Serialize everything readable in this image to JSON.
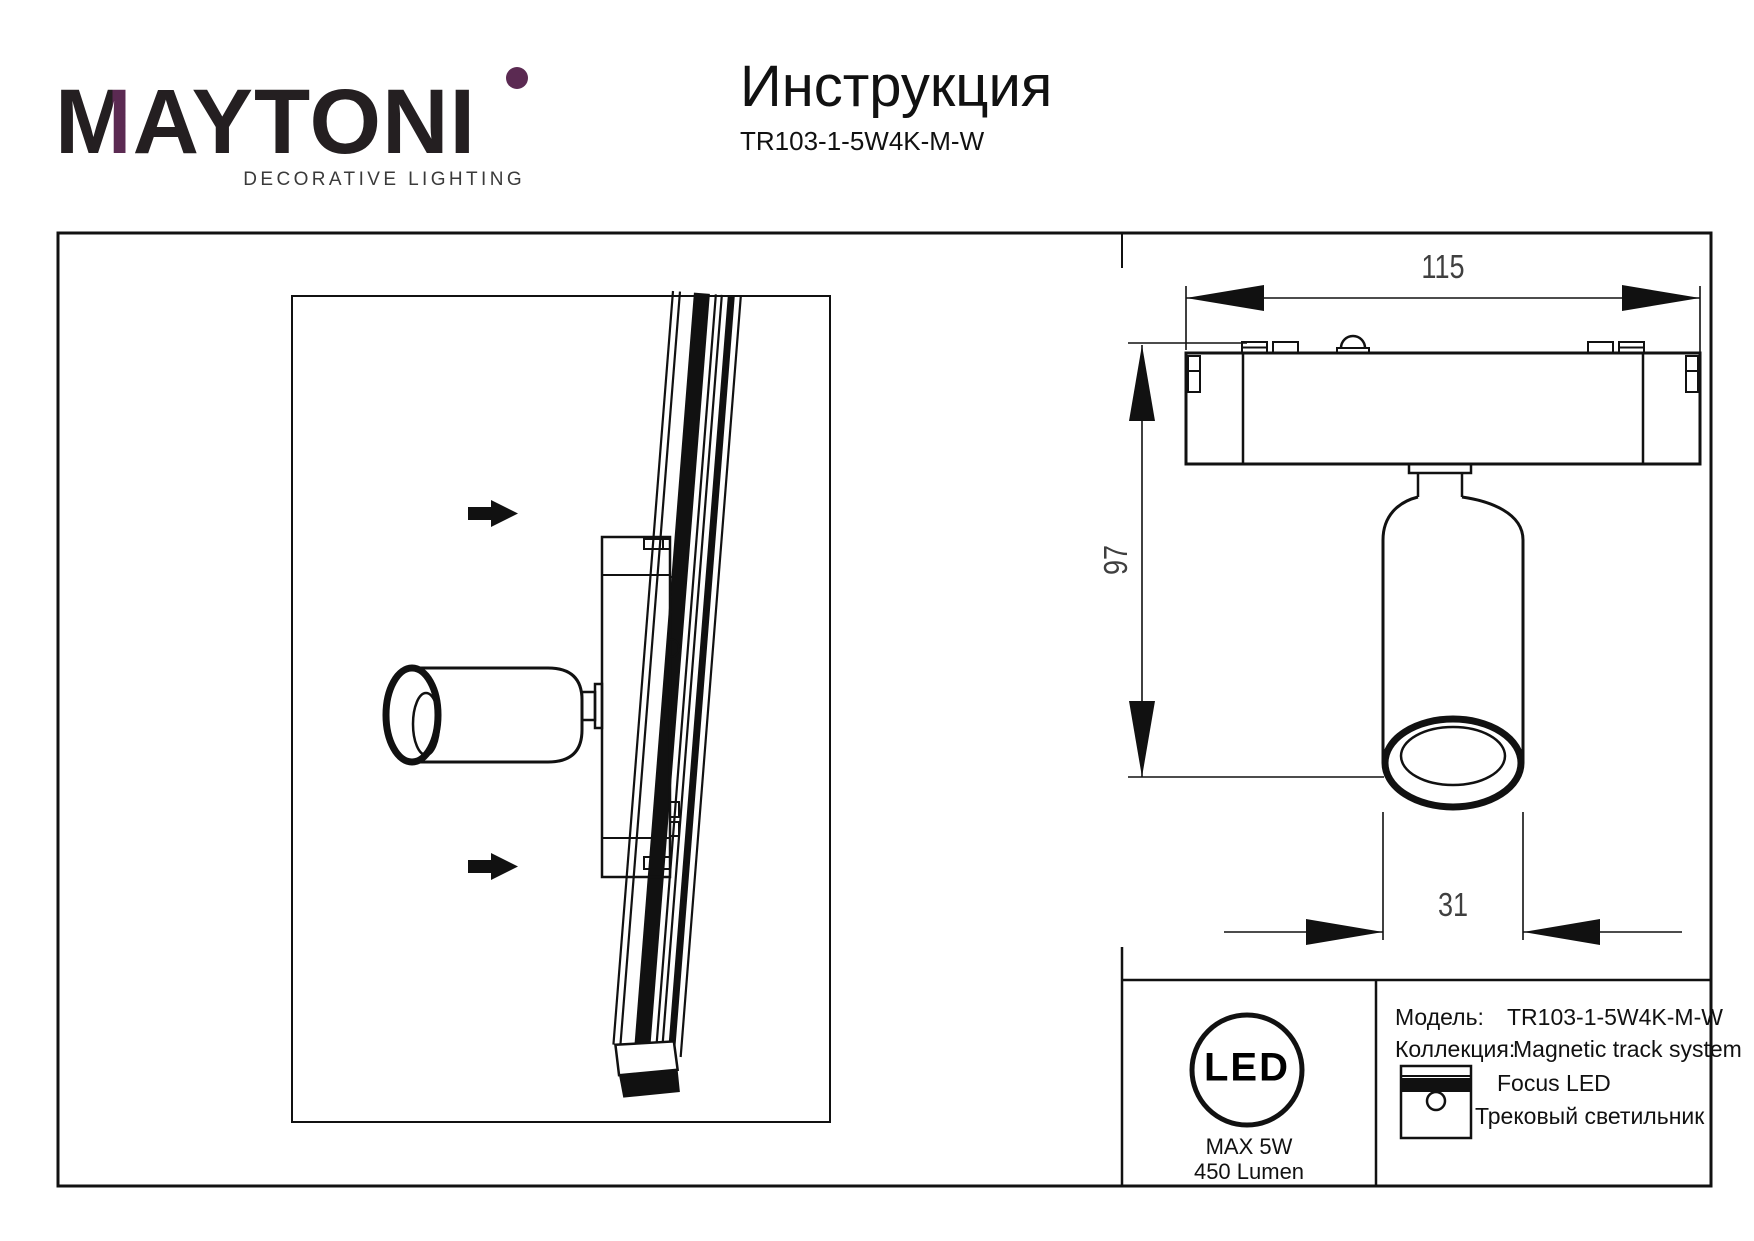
{
  "header": {
    "logo": {
      "m": "M",
      "rest": "AYTON",
      "i": "I",
      "tagline": "DECORATIVE LIGHTING",
      "accent_color": "#5b2a52"
    },
    "title": "Инструкция",
    "model": "TR103-1-5W4K-M-W"
  },
  "drawing": {
    "dim_width": "115",
    "dim_height": "97",
    "dim_diameter": "31"
  },
  "info_panel": {
    "led_badge": {
      "text": "LED",
      "max_power": "MAX 5W",
      "lumen": "450 Lumen"
    },
    "model_label": "Модель:",
    "model_value": "TR103-1-5W4K-M-W",
    "collection_label": "Коллекция:",
    "collection_value": "Magnetic track system",
    "product_line1": "Focus LED",
    "product_line2": "Трековый светильник"
  }
}
